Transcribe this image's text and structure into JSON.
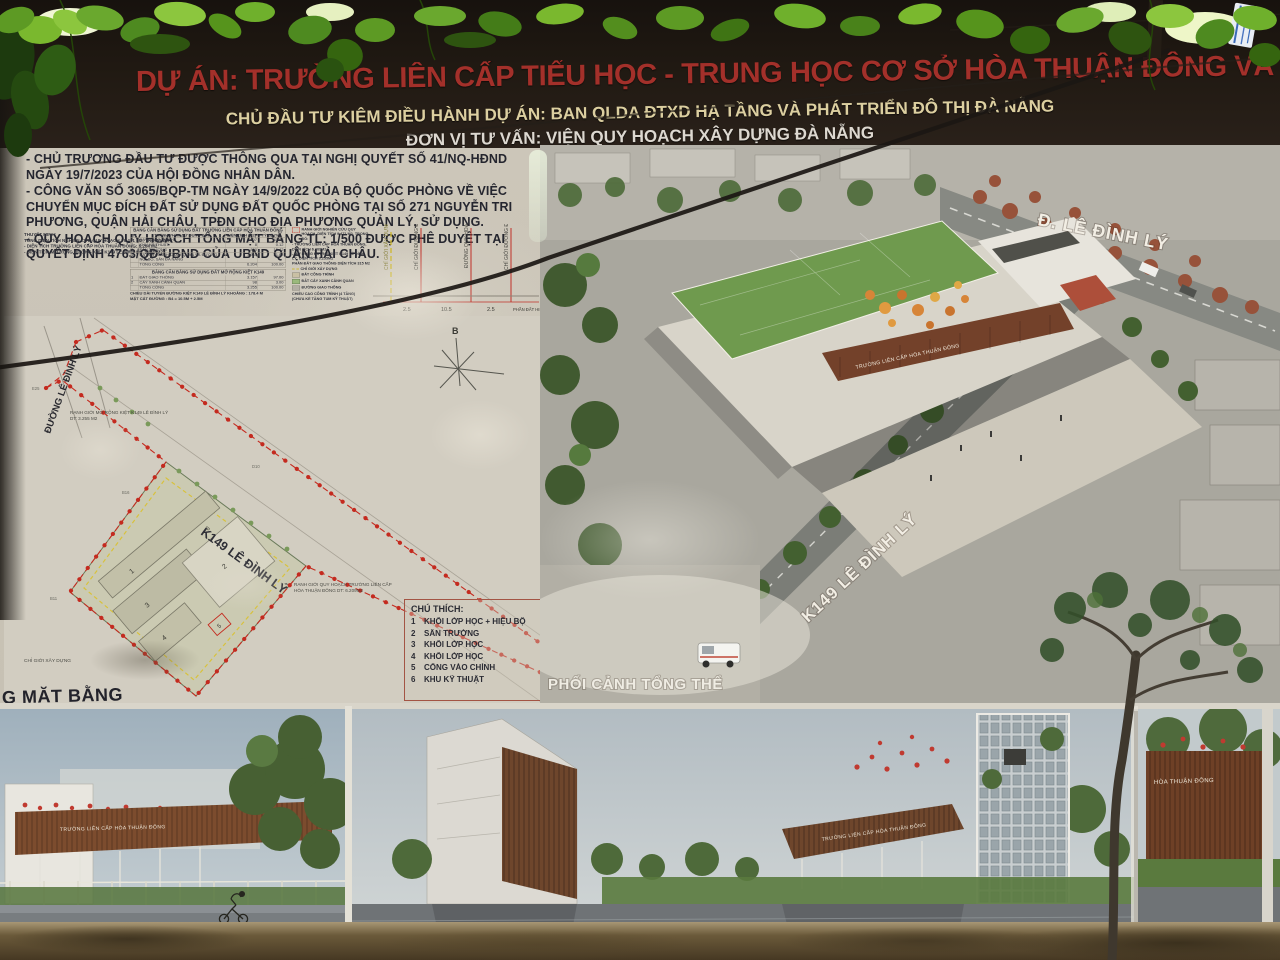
{
  "billboard": {
    "title": "DỰ ÁN: TRƯỜNG LIÊN CẤP TIỂU HỌC - TRUNG HỌC CƠ SỞ HÒA THUẬN ĐÔNG VÀ MỞ RỘNG KIỆT 149 LÊ ĐÌNH LÝ",
    "investor_line": "CHỦ ĐẦU TƯ KIÊM ĐIỀU HÀNH DỰ ÁN: BAN QLDA ĐTXD HẠ TẦNG VÀ PHÁT TRIỂN ĐÔ THỊ ĐÀ NẴNG",
    "consultant_line": "ĐƠN VỊ TƯ VẤN: VIỆN QUY HOẠCH XÂY DỰNG ĐÀ NẴNG",
    "colors": {
      "title_red": "#a3302a",
      "investor_yellow": "#dccfa0",
      "consultant_white": "#ddd8d0",
      "header_bg": "#201912",
      "board_bg": "#c9c3b6",
      "boundary_red": "#c42a1f"
    }
  },
  "notes": {
    "items": [
      "- CHỦ TRƯƠNG ĐẦU TƯ ĐƯỢC THÔNG QUA TẠI NGHỊ QUYẾT SỐ 41/NQ-HĐND NGÀY 19/7/2023 CỦA HỘI ĐỒNG NHÂN DÂN.",
      "- CÔNG VĂN SỐ 3065/BQP-TM NGÀY 14/9/2022 CỦA BỘ QUỐC PHÒNG VỀ VIỆC CHUYỂN MỤC ĐÍCH ĐẤT SỬ DỤNG ĐẤT QUỐC PHÒNG TẠI SỐ 271 NGUYỄN TRI PHƯƠNG, QUẬN HẢI CHÂU, TPĐN CHO ĐỊA PHƯƠNG QUẢN LÝ, SỬ DỤNG.",
      "- QUY HOẠCH QUY HOẠCH TỔNG MẶT BẰNG TL: 1/500 ĐƯỢC PHÊ DUYỆT TẠI QUYẾT ĐỊNH 4763/QĐ-UBND CỦA UBND QUẬN HẢI CHÂU."
    ]
  },
  "thuyet_minh": {
    "title": "THUYẾT MINH:",
    "lines": [
      "TỔNG DIỆN TÍCH NGHIÊN CỨU QUY HOẠCH : 9.471 M2; TRONG ĐÓ:",
      "- DIỆN TÍCH TRƯỜNG LIÊN CẤP HÒA THUẬN ĐÔNG: 6.204 M2",
      "- DIỆN TÍCH MỞ RỘNG ĐƯỜNG KIỆT K149 LÊ ĐÌNH LÝ: 3.260 M2"
    ]
  },
  "land_use": {
    "table1_title": "BẢNG CÂN BẰNG SỬ DỤNG ĐẤT TRƯỜNG LIÊN CẤP HÒA THUẬN ĐÔNG",
    "headers": [
      "TT",
      "THÀNH PHẦN SỬ DỤNG ĐẤT",
      "DIỆN TÍCH (M2)",
      "TỶ LỆ (%)"
    ],
    "table1_rows": [
      [
        "1",
        "ĐẤT CÔNG TRÌNH",
        "2.607",
        "41.98"
      ],
      [
        "2",
        "KHU KỸ THUẬT",
        "8",
        "0.12"
      ],
      [
        "3",
        "SÂN TRƯỜNG",
        "800",
        "15.42"
      ],
      [
        "4",
        "ĐẤT CÂY XANH CẢNH QUAN VÀ ĐƯỜNG NỘI BỘ, SÂN ĐA NĂNG",
        "1.945",
        "31.88"
      ],
      [
        "",
        "TỔNG CỘNG",
        "6.204",
        "100.00"
      ]
    ],
    "table2_title": "BẢNG CÂN BẰNG SỬ DỤNG ĐẤT MỞ RỘNG KIỆT K149",
    "table2_rows": [
      [
        "1",
        "ĐẤT GIAO THÔNG",
        "3.157",
        "97.00"
      ],
      [
        "2",
        "CÂY XANH CẢNH QUAN",
        "98",
        "3.00"
      ],
      [
        "",
        "TỔNG CỘNG",
        "3.255",
        "100.00"
      ]
    ],
    "note_line1": "CHIỀU DÀI TUYẾN ĐƯỜNG KIỆT K149 LÊ ĐÌNH LÝ KHOẢNG : 178.4 M",
    "note_line2": "MẶT CẮT ĐƯỜNG : B4 = 10.5M + 2.5M"
  },
  "map_legend": {
    "boundary_label": "RANH GIỚI NGHIÊN CỨU QUY HOẠCH, DIỆN TÍCH 9.471 M2, TRONG ĐÓ:",
    "boundary_sub1": "- TRƯỜNG LIÊN CẤP HÒA THUẬN ĐÔNG, DIỆN TÍCH 6.209M2",
    "boundary_sub2": "- MỞ RỘNG ĐƯỜNG KIỆT K149 LÊ ĐÌNH LÝ, DIỆN TÍCH 3.255M2",
    "traffic_label": "PHẦN ĐẤT GIAO THÔNG DIỆN TÍCH 315 M2",
    "build_line_label": "CHỈ GIỚI XÂY DỰNG",
    "construction_label": "ĐẤT CÔNG TRÌNH",
    "green_label": "ĐẤT CÂY XANH CẢNH QUAN",
    "road_label": "ĐƯỜNG GIAO THÔNG",
    "height_note1": "CHIỀU CAO CÔNG TRÌNH (4 TẦNG)",
    "height_note2": "(CHƯA KỂ TẦNG TUM KỸ THUẬT)"
  },
  "cross_section": {
    "labels": [
      "CHỈ GIỚI XÂY DỰNG",
      "CHỈ GIỚI ĐƯỜNG ĐỎ",
      "ĐƯỜNG QUY HOẠCH",
      "CHỈ GIỚI ĐƯỜNG ĐỎ"
    ],
    "dims": [
      "2.5",
      "10.5",
      "2.5"
    ],
    "range": "16.5-20.7",
    "existing": "PHẦN ĐẤT HIỆN TRẠNG",
    "caption": "MẶT CẮT 1-1"
  },
  "site_plan": {
    "road_vertical": "ĐƯỜNG LÊ ĐÌNH LÝ",
    "road_diagonal": "K149 LÊ ĐÌNH LÝ",
    "expand_note1": "RANH GIỚI MỞ RỘNG KIỆT K149 LÊ ĐÌNH LÝ",
    "expand_note2": "DT: 3.255 M2",
    "school_note1": "RANH GIỚI QUY HOẠCH TRƯỜNG LIÊN CẤP",
    "school_note2": "HÒA THUẬN ĐÔNG DT: 6.209M2",
    "build_line": "CHỈ GIỚI XÂY DỰNG",
    "compass": "B",
    "caption": "G MẶT BẰNG",
    "markers": [
      "E25",
      "B11",
      "D10",
      "B16"
    ]
  },
  "chu_thich": {
    "title": "CHÚ THÍCH:",
    "rows": [
      [
        "1",
        "KHỐI LỚP HỌC + HIỆU BỘ"
      ],
      [
        "2",
        "SÂN TRƯỜNG"
      ],
      [
        "3",
        "KHỐI LỚP HỌC"
      ],
      [
        "4",
        "KHỐI LỚP HỌC"
      ],
      [
        "5",
        "CỔNG VÀO CHÍNH"
      ],
      [
        "6",
        "KHU KỸ THUẬT"
      ]
    ]
  },
  "perspective": {
    "caption": "PHỐI CẢNH TỔNG THỂ",
    "road_label_top": "Đ. LÊ ĐÌNH LÝ",
    "road_label_diag": "K149 LÊ ĐÌNH LÝ",
    "building_sign": "TRƯỜNG LIÊN CẤP HÒA THUẬN ĐÔNG"
  },
  "bottom_renderings": {
    "sign_left": "TRƯỜNG LIÊN CẤP HÒA THUẬN ĐÔNG",
    "sign_mid": "TRƯỜNG LIÊN CẤP HÒA THUẬN ĐÔNG",
    "sign_right": "HÒA THUẬN ĐÔNG"
  }
}
